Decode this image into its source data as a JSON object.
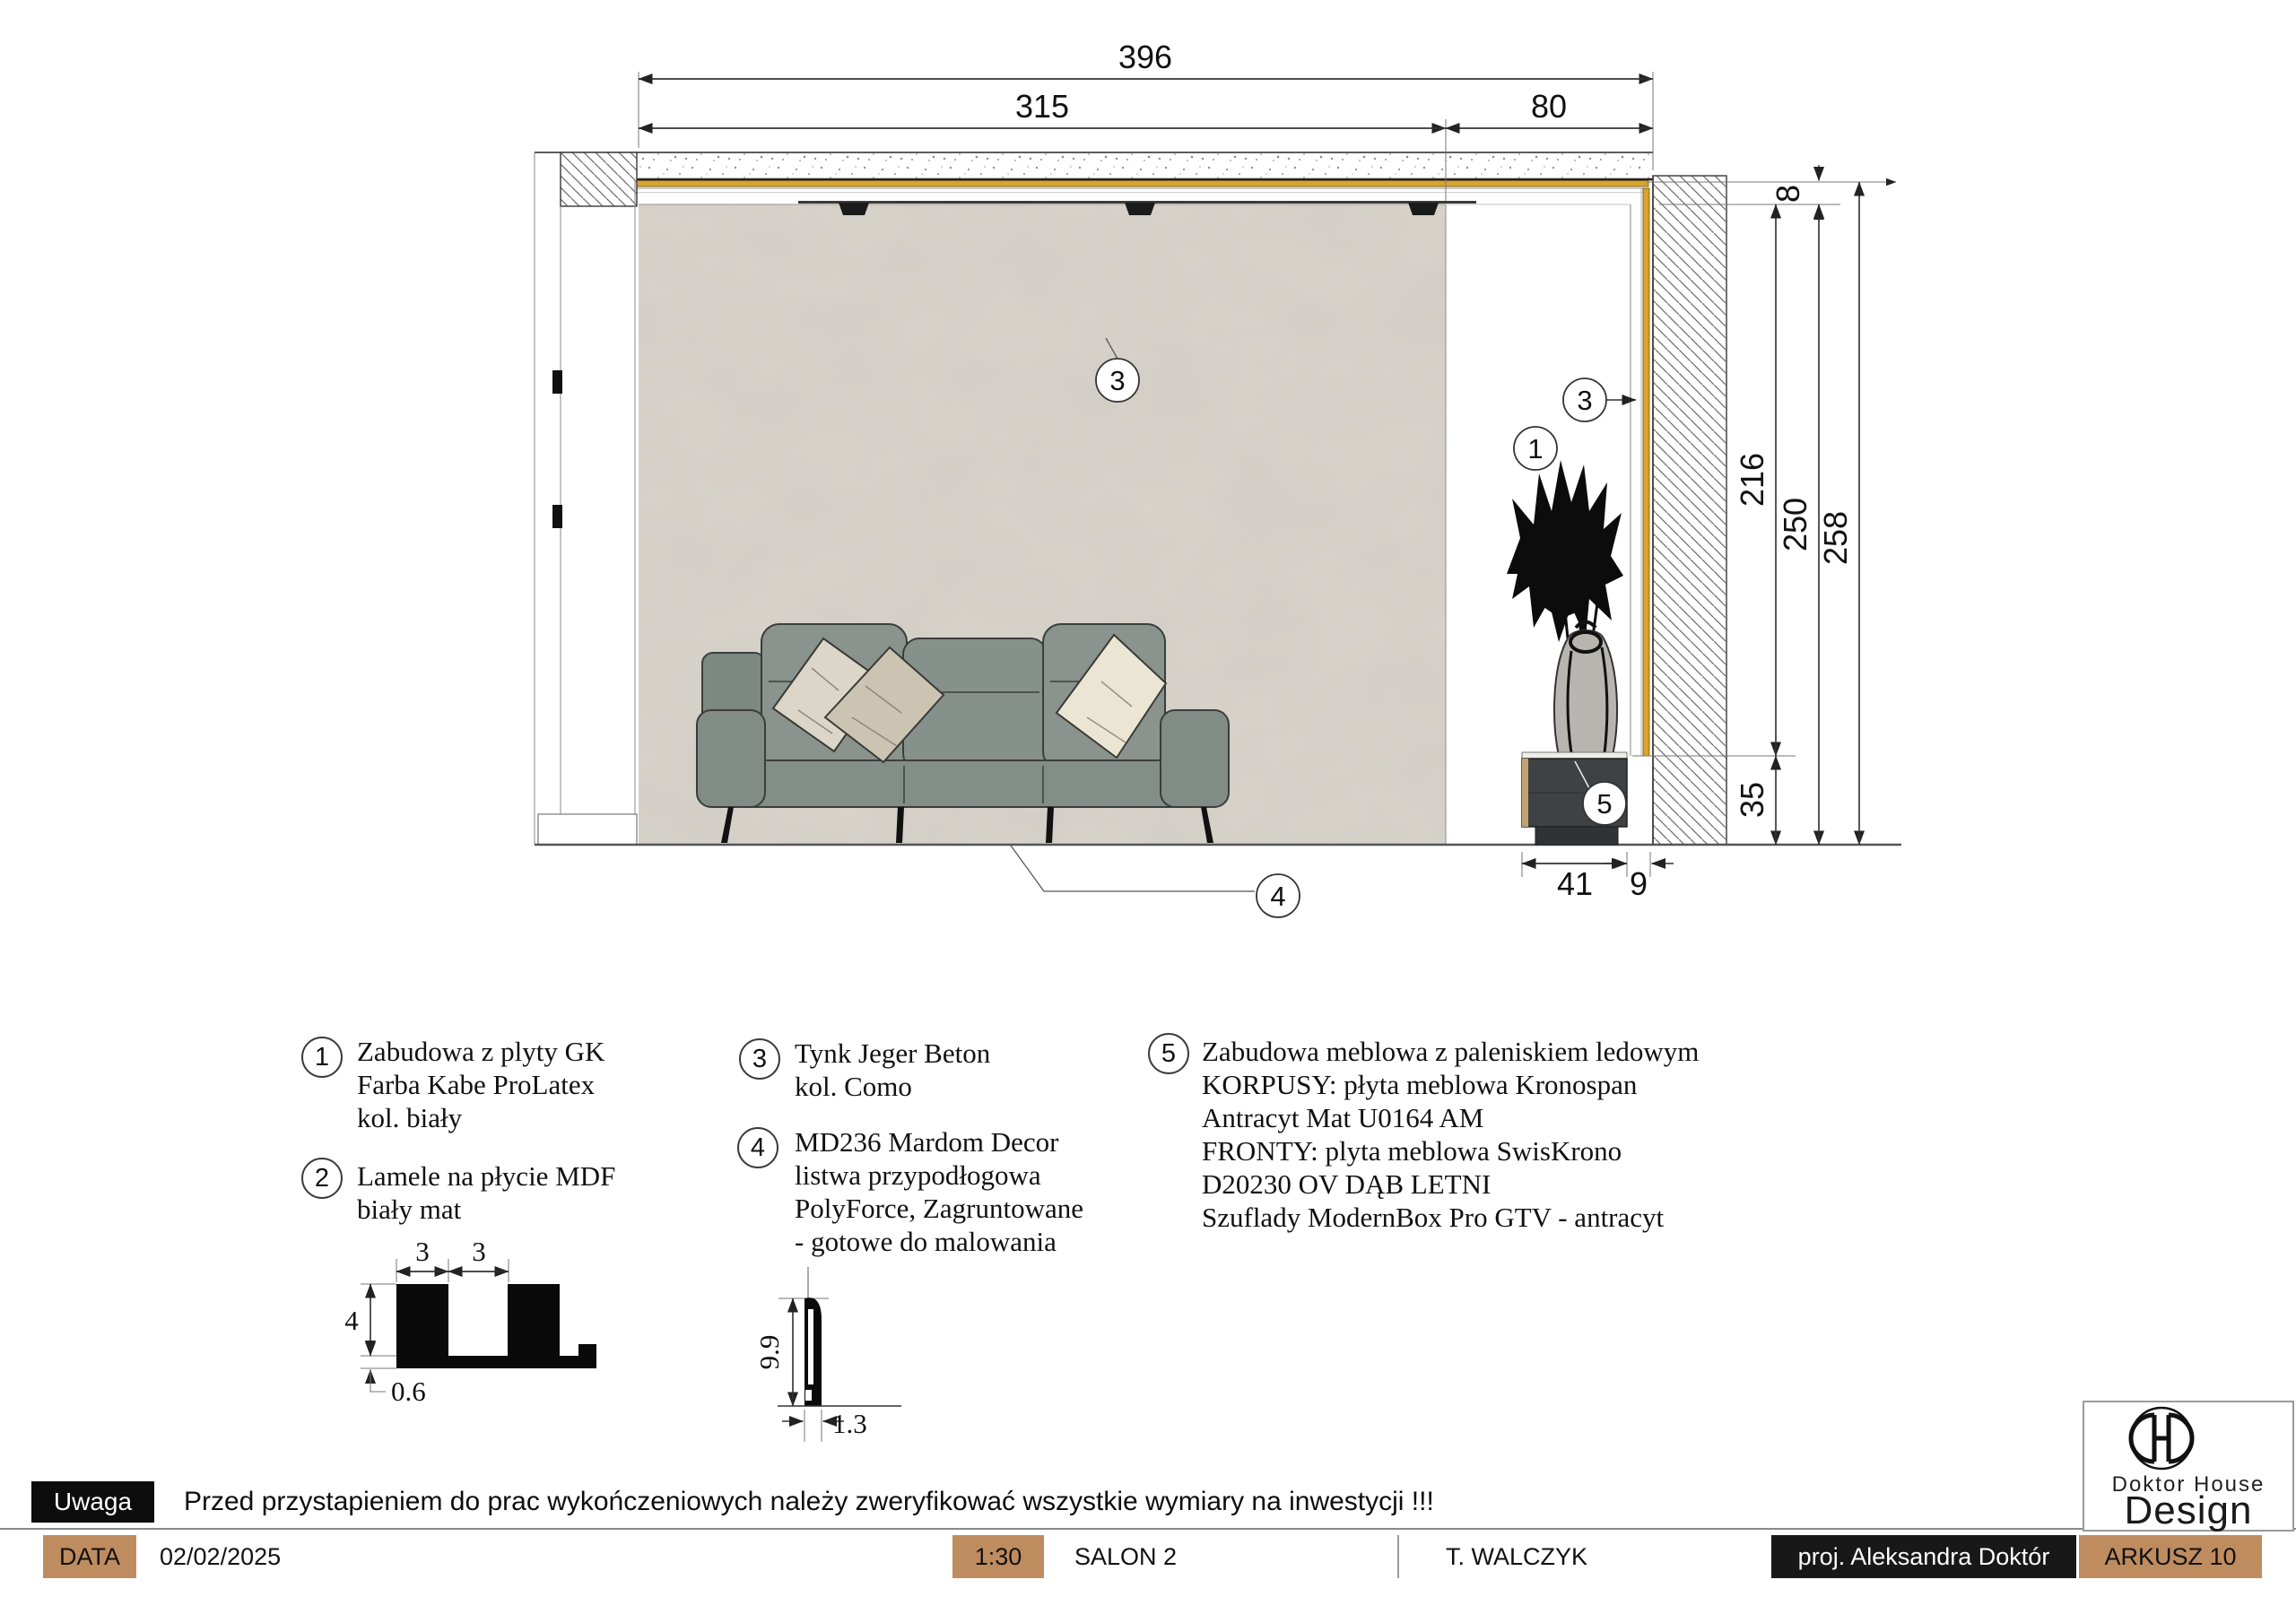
{
  "dims": {
    "total_width": "396",
    "wall_width": "315",
    "niche_width": "80",
    "recess_height": "8",
    "niche_height": "216",
    "ceiling_height": "250",
    "slab_height": "258",
    "cabinet_height": "35",
    "cabinet_width": "41",
    "side_gap": "9"
  },
  "callouts": {
    "c1": "1",
    "c2": "2",
    "c3": "3",
    "c4": "4",
    "c5": "5"
  },
  "lamella_profile": {
    "slat_width": "3",
    "gap_width": "3",
    "height": "4",
    "base": "0.6"
  },
  "skirting_profile": {
    "height": "9.9",
    "width": "1.3"
  },
  "legend": {
    "items": [
      {
        "num": "1",
        "lines": [
          "Zabudowa z plyty GK",
          "Farba Kabe ProLatex",
          "kol. biały"
        ]
      },
      {
        "num": "2",
        "lines": [
          "Lamele na płycie MDF",
          "biały mat"
        ]
      },
      {
        "num": "3",
        "lines": [
          "Tynk Jeger Beton",
          "kol. Como"
        ]
      },
      {
        "num": "4",
        "lines": [
          "MD236 Mardom Decor",
          "listwa przypodłogowa",
          "PolyForce, Zagruntowane",
          "- gotowe do malowania"
        ]
      },
      {
        "num": "5",
        "lines": [
          "Zabudowa meblowa z paleniskiem ledowym",
          "KORPUSY: płyta meblowa Kronospan",
          "Antracyt Mat U0164 AM",
          "FRONTY: plyta meblowa SwisKrono",
          "D20230 OV DĄB LETNI",
          "Szuflady ModernBox Pro GTV - antracyt"
        ]
      }
    ]
  },
  "note": {
    "badge": "Uwaga",
    "text": "Przed przystapieniem do prac wykończeniowych należy zweryfikować wszystkie wymiary na inwestycji !!!"
  },
  "titlebar": {
    "data_label": "DATA",
    "date": "02/02/2025",
    "scale": "1:30",
    "room": "SALON 2",
    "client": "T. WALCZYK",
    "designer": "proj. Aleksandra Doktór",
    "sheet": "ARKUSZ 10"
  },
  "logo": {
    "line1": "Doktor House",
    "line2": "Design"
  },
  "colors": {
    "gold_strip": "#D9A42C",
    "titlebar_tan": "#BF8C60",
    "wall_plaster": "#D8D4CC",
    "sofa_gray": "#8A938D",
    "cabinet_anthracite": "#3E4245",
    "badge_black": "#0D0D0D"
  }
}
